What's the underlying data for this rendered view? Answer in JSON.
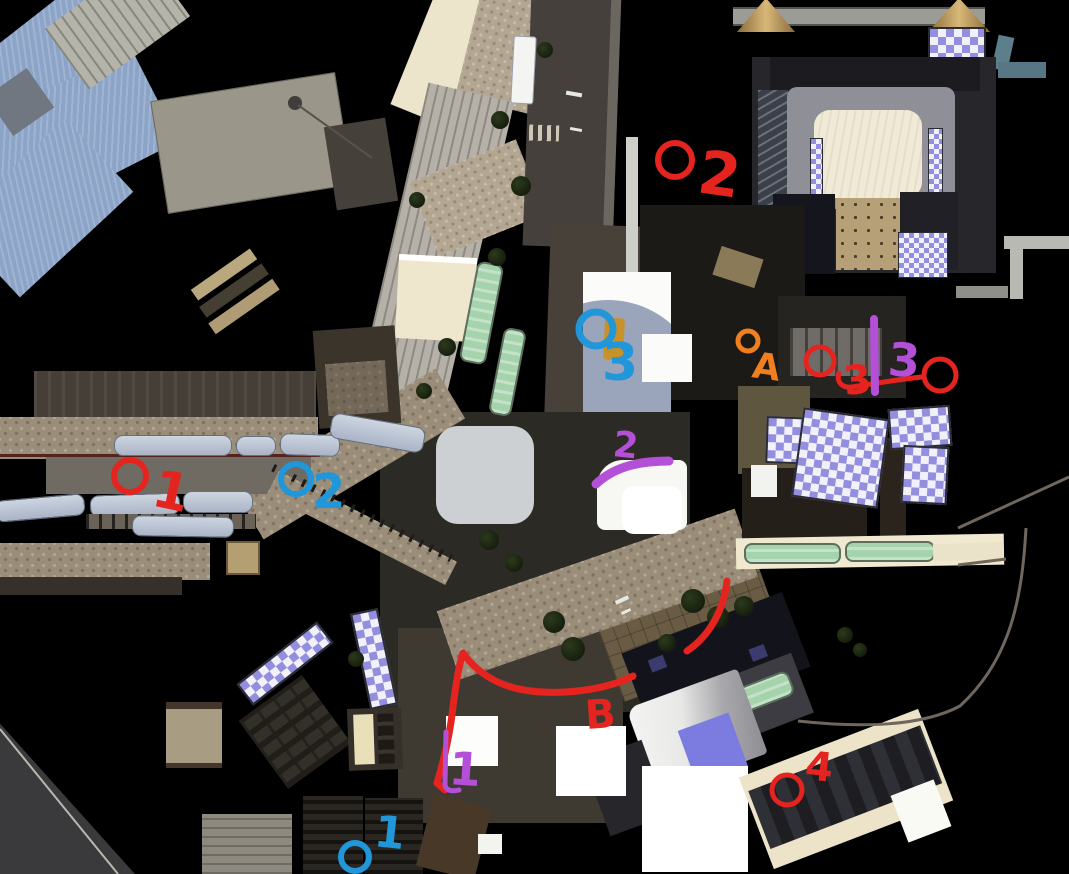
{
  "annotations": {
    "palette": {
      "red": "#e52420",
      "blue": "#2196d8",
      "orange": "#ef7f1f",
      "purple": "#b44fd8"
    },
    "circles": [
      {
        "name": "red-circle-1",
        "color": "red",
        "cx": 130,
        "cy": 476,
        "r": 16,
        "width": 6
      },
      {
        "name": "red-circle-2",
        "color": "red",
        "cx": 675,
        "cy": 160,
        "r": 17,
        "width": 6
      },
      {
        "name": "red-circle-3",
        "color": "red",
        "cx": 820,
        "cy": 361,
        "r": 14,
        "width": 5
      },
      {
        "name": "red-circle-right",
        "color": "red",
        "cx": 940,
        "cy": 375,
        "r": 16,
        "width": 5
      },
      {
        "name": "red-circle-4",
        "color": "red",
        "cx": 787,
        "cy": 790,
        "r": 15,
        "width": 5
      },
      {
        "name": "blue-circle-3",
        "color": "blue",
        "cx": 596,
        "cy": 329,
        "r": 17,
        "width": 7
      },
      {
        "name": "blue-circle-2",
        "color": "blue",
        "cx": 296,
        "cy": 479,
        "r": 15,
        "width": 6
      },
      {
        "name": "blue-circle-1",
        "color": "blue",
        "cx": 355,
        "cy": 857,
        "r": 14,
        "width": 6
      },
      {
        "name": "orange-circle-a",
        "color": "orange",
        "cx": 748,
        "cy": 341,
        "r": 10,
        "width": 5
      }
    ],
    "labels": [
      {
        "name": "red-label-1",
        "color": "red",
        "text": "1",
        "x": 150,
        "y": 505,
        "size": 52,
        "rotate": 12
      },
      {
        "name": "red-label-2",
        "color": "red",
        "text": "2",
        "x": 696,
        "y": 192,
        "size": 60,
        "rotate": 8
      },
      {
        "name": "red-label-3",
        "color": "red",
        "text": "3",
        "x": 845,
        "y": 395,
        "size": 40,
        "rotate": -6
      },
      {
        "name": "red-label-4",
        "color": "red",
        "text": "4",
        "x": 804,
        "y": 779,
        "size": 40,
        "rotate": 6
      },
      {
        "name": "red-label-b",
        "color": "red",
        "text": "B",
        "x": 586,
        "y": 729,
        "size": 40,
        "rotate": -4
      },
      {
        "name": "blue-label-3",
        "color": "blue",
        "text": "3",
        "x": 602,
        "y": 380,
        "size": 52,
        "rotate": 0
      },
      {
        "name": "blue-label-2",
        "color": "blue",
        "text": "2",
        "x": 312,
        "y": 508,
        "size": 48,
        "rotate": 0
      },
      {
        "name": "blue-label-1",
        "color": "blue",
        "text": "1",
        "x": 373,
        "y": 846,
        "size": 44,
        "rotate": 6
      },
      {
        "name": "orange-label-a",
        "color": "orange",
        "text": "A",
        "x": 751,
        "y": 377,
        "size": 36,
        "rotate": 8
      },
      {
        "name": "purple-label-3",
        "color": "purple",
        "text": "3",
        "x": 887,
        "y": 375,
        "size": 46,
        "rotate": 4
      },
      {
        "name": "purple-label-2",
        "color": "purple",
        "text": "2",
        "x": 612,
        "y": 456,
        "size": 36,
        "rotate": 6
      },
      {
        "name": "purple-label-1",
        "color": "purple",
        "text": "1",
        "x": 448,
        "y": 784,
        "size": 46,
        "rotate": 4
      }
    ],
    "strokes": [
      {
        "name": "red-route-b",
        "color": "red",
        "width": 7,
        "path": "M633,676 C606,690 560,696 524,690 C494,685 474,669 463,653 C457,671 454,700 451,722 C447,748 441,770 437,783 L445,790"
      },
      {
        "name": "red-arc",
        "color": "red",
        "width": 7,
        "path": "M727,581 C724,608 711,635 687,651"
      },
      {
        "name": "red-link-3",
        "color": "red",
        "width": 5,
        "path": "M839,373 C836,383 843,388 852,387 C878,383 901,379 922,377"
      },
      {
        "name": "purple-divider-3",
        "color": "purple",
        "width": 8,
        "path": "M874,319 L875,392"
      },
      {
        "name": "purple-swoosh-2",
        "color": "purple",
        "width": 9,
        "path": "M596,484 C612,469 634,461 669,461"
      },
      {
        "name": "purple-hook-1",
        "color": "purple",
        "width": 5,
        "path": "M446,732 L445,784 C445,790 451,792 459,790"
      }
    ]
  }
}
